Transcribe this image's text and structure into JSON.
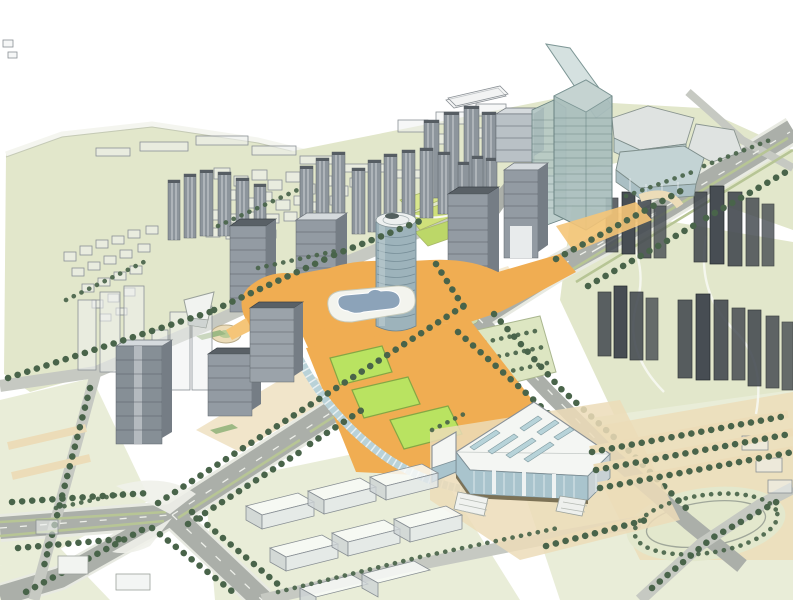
{
  "scene": {
    "description": "Aerial axonometric 3D massing rendering of a city master plan: central business district towers around an orange pedestrian deck with a figure-shaped pond and lawns, a tall glass landmark tower with spire, an exhibition hall with skylit roof, wireframe residential and village massing blocks, green fields, orchards and tree-lined arterial roads.",
    "regions": [
      {
        "name": "northwest-village",
        "label": "low-rise village massing on green field"
      },
      {
        "name": "north-fields",
        "label": "open green fields"
      },
      {
        "name": "northeast-podium",
        "label": "glass podium blocks"
      },
      {
        "name": "east-residential",
        "label": "high-rise residential massing clusters"
      },
      {
        "name": "central-cbd",
        "label": "central business district towers"
      },
      {
        "name": "central-plaza",
        "label": "orange pedestrian deck with lawns and pond"
      },
      {
        "name": "exhibition-hall",
        "label": "exhibition hall with skylight roof"
      },
      {
        "name": "southeast-parking",
        "label": "tree-lined parking rows and oval field"
      },
      {
        "name": "south-warehouses",
        "label": "translucent low warehouse blocks"
      }
    ],
    "landmarks": [
      {
        "name": "glass-skyscraper",
        "label": "glass tower with spire"
      },
      {
        "name": "cylindrical-tower",
        "label": "cylindrical tower"
      },
      {
        "name": "guitar-pond",
        "label": "figure-shaped pond on deck"
      }
    ]
  },
  "palette": {
    "sky": "#ffffff",
    "terrain": "#e2e7cb",
    "terrain2": "#e9edd8",
    "wall": "#f4f5ef",
    "sidewalk": "#e8eae2",
    "road": "#abafa9",
    "road_minor": "#c6c9c2",
    "median": "#b7c595",
    "tree": "#49644a",
    "deck": "#f0ad52",
    "deck_light": "#f5c578",
    "lawn": "#b9e361",
    "lawn_border": "#85a744",
    "tan": "#ecdcb8",
    "shrub": "#9db984",
    "water": "#8ca3b9",
    "tower_face": "#939ba3",
    "tower_side": "#757d85",
    "tower_top": "#d5dadd",
    "tower_line": "#555c64",
    "dark_tower": "#474d53",
    "slab": "#8d959c",
    "roof_white": "#f4f6f3",
    "skylight": "#b7d3d9",
    "glass_wall": "#a9c4cd",
    "mullion": "#e9f0f1",
    "path_white": "#f7f8f2"
  }
}
